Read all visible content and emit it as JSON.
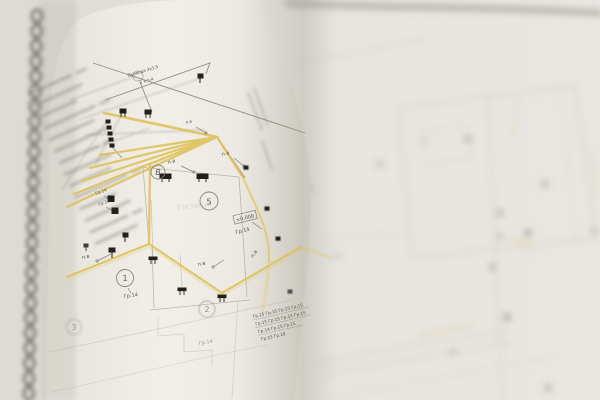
{
  "scene": {
    "alt": "Photograph of an open spiral-bound book of electrical floor-plan blueprints; left page in focus with yellow-highlighted wiring routes, right page heavily out of focus"
  },
  "colors": {
    "highlight_yellow": "#e6c85e",
    "paper_white": "#f7f5f0",
    "background": "#e9e7e2",
    "ink_gray": "#76726a",
    "symbol_black": "#23201c"
  },
  "plan": {
    "labels": {
      "pv": "п.в",
      "gr14": "Гр.14",
      "gr13": "Гр.13",
      "level": "±0.000",
      "room": "Гостиная",
      "wire_note_1": "Провода 3х1,5",
      "wire_note_2": "2 х п.в"
    },
    "circles": {
      "b": "В",
      "n5": "5",
      "n1": "1",
      "n2": "2",
      "n3": "3"
    },
    "group_table": [
      "Гр.15  Гр.15  Гр.15  Гр.15",
      "Гр.15  Гр.15  Гр.15  Гр.15",
      "Гр.14  Гр.15  Гр.15",
      "Гр.15  Гр.10"
    ]
  }
}
